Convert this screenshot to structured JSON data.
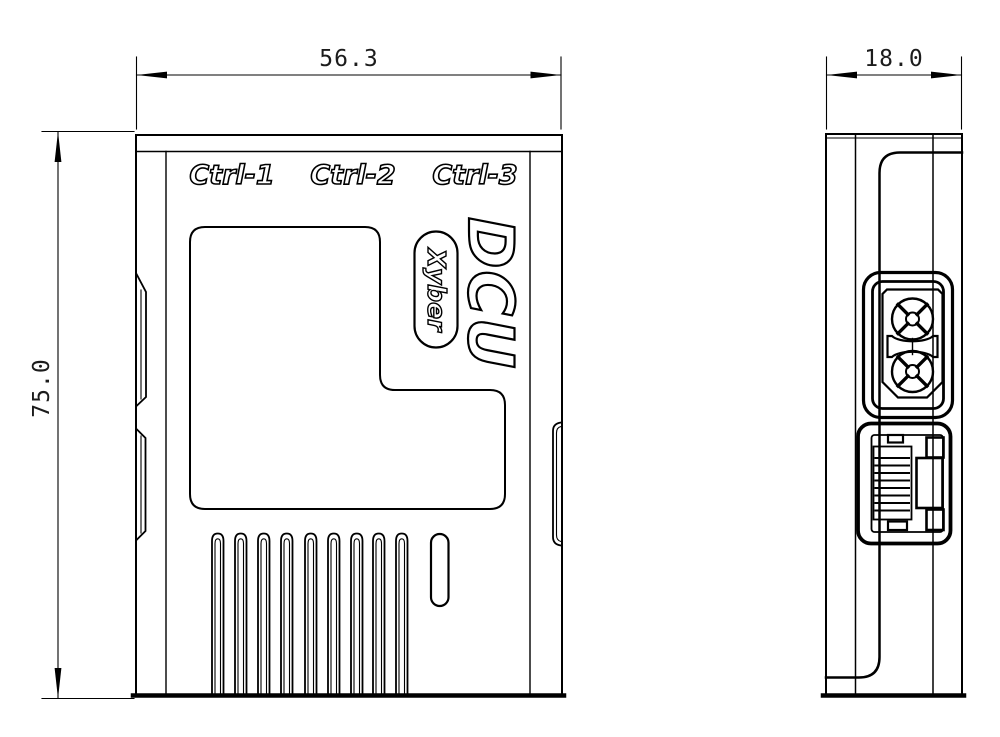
{
  "title": "DCU enclosure dimensional drawing",
  "front_view": {
    "port_labels": [
      "Ctrl-1",
      "Ctrl-2",
      "Ctrl-3"
    ],
    "logo": "DCU",
    "brand": "Xyber",
    "width_dim": "56.3",
    "height_dim": "75.0"
  },
  "side_view": {
    "depth_dim": "18.0",
    "connectors": [
      "xt30-power-connector",
      "rj45-ethernet-port"
    ]
  },
  "colors": {
    "line": "#000000",
    "background": "#ffffff",
    "dim_text": "#1c1c1c"
  }
}
